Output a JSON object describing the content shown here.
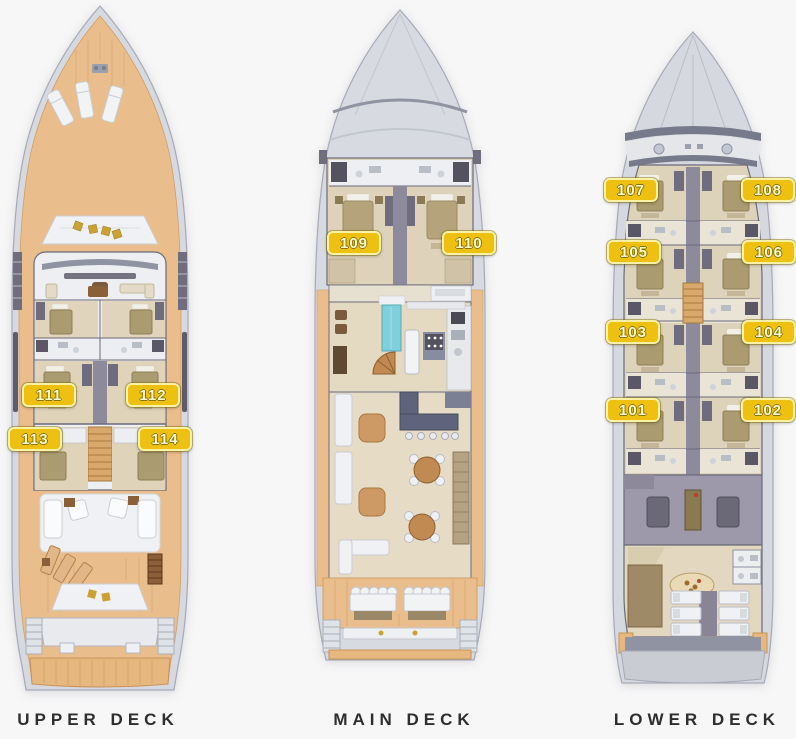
{
  "page": {
    "background_color": "#f7f7f8"
  },
  "decks": [
    {
      "name": "UPPER DECK",
      "cabin_labels": [
        "111",
        "112",
        "113",
        "114"
      ]
    },
    {
      "name": "MAIN DECK",
      "cabin_labels": [
        "109",
        "110"
      ]
    },
    {
      "name": "LOWER DECK",
      "cabin_labels": [
        "107",
        "108",
        "105",
        "106",
        "103",
        "104",
        "101",
        "102"
      ]
    }
  ],
  "colors": {
    "badge_background": "#eec011",
    "badge_border": "#f9f2a5",
    "badge_text": "#fdf8d0",
    "deck_wood": "#e9bd8c",
    "hull": "#d7d9e0",
    "cabin_floor": "#ded2ba",
    "corridor": "#8d8a9c",
    "pool": "#7fd0dc",
    "engine_room": "#9d99ab",
    "caption_text": "#2e2e2e"
  }
}
